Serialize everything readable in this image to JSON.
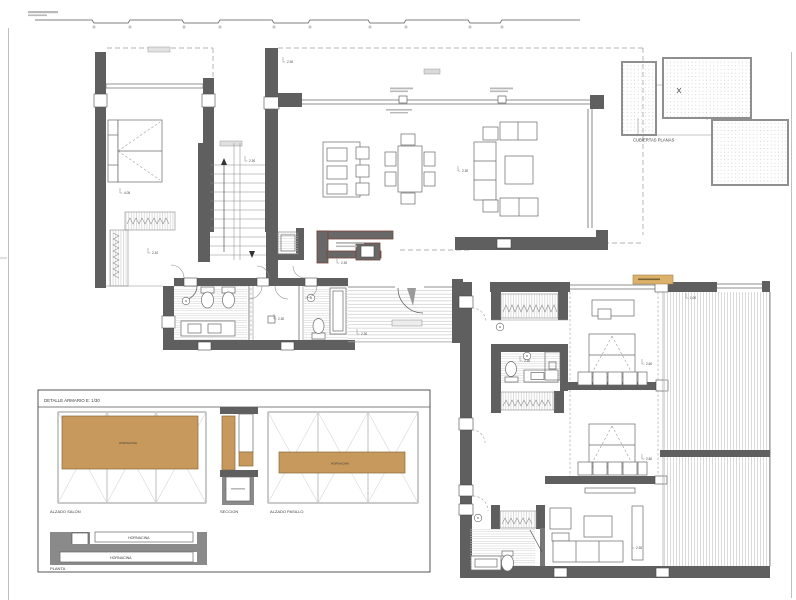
{
  "drawing": {
    "key_plan": {
      "title": "CUBIERTAS PLANAS"
    },
    "detail": {
      "title": "DETALLE ARMARIO E: 1/30",
      "elevation_left": "ALZADO SALON",
      "section": "SECCION",
      "elevation_right": "ALZADO PASILLO",
      "panel_left": "HORNACINA",
      "panel_right": "HORNACINA",
      "plan": "PLANTA",
      "plan_bar_top": "HORNACINA",
      "plan_bar_bottom": "HORNACINA"
    },
    "dims": [
      "2.30",
      "4.05",
      "2.30",
      "2.10",
      "2.30",
      "2.30",
      "2.30",
      "2.30",
      "2.30",
      "2.60",
      "2.60",
      "1.00",
      "2.30"
    ],
    "colors": {
      "wall": "#5f5f5f",
      "wood": "#c8995c",
      "tan_highlight": "#dcb26a",
      "hatch": "#cdcdcd",
      "porch_trim": "#77433a"
    }
  }
}
